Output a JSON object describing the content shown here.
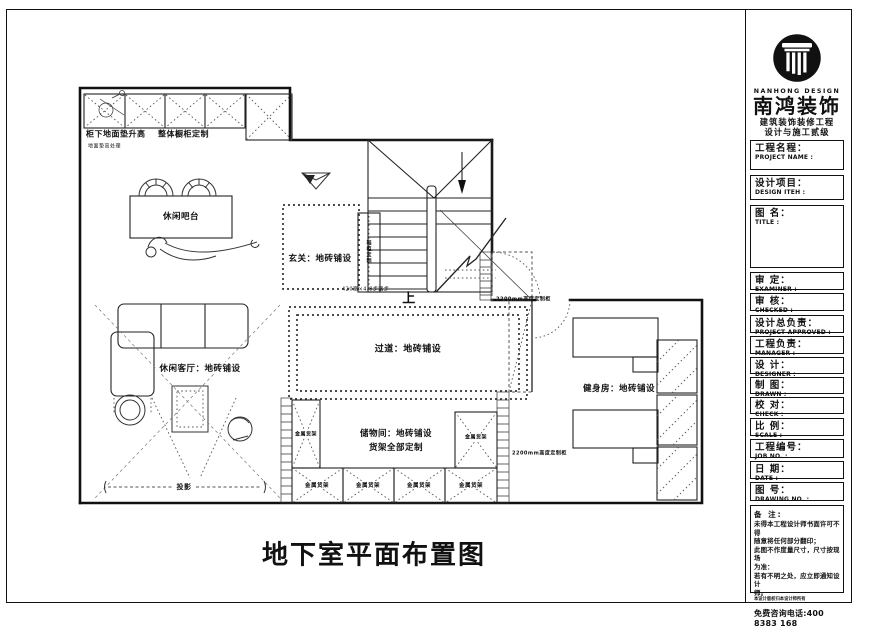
{
  "sheet": {
    "main_title": "地下室平面布置图"
  },
  "plan": {
    "labels": {
      "cabinet_note1": "柜下地面垫升高",
      "cabinet_note2": "整体橱柜定制",
      "floor_note": "地面垫高处理",
      "bar": "休闲吧台",
      "entry": "玄关：地砖铺设",
      "shoe_cabinet": "鞋柜定制",
      "stair_up": "上",
      "stair_note": "420宽×4-8步踏步",
      "cabinet_2200": "2200mm高度定制柜",
      "corridor": "过道：地砖铺设",
      "living": "休闲客厅：地砖铺设",
      "storage_line1": "储物间：地砖铺设",
      "storage_line2": "货架全部定制",
      "shelf": "金属货架",
      "gym": "健身房：地砖铺设",
      "projection": "投影"
    }
  },
  "titleblock": {
    "brand": {
      "logo_en": "NANHONG DESIGN",
      "name_zh": "南鸿装饰",
      "cert_line1": "建筑装饰装修工程",
      "cert_line2": "设计与施工贰级",
      "license_no": "*NO：X233021396"
    },
    "fields": [
      {
        "zh": "工程名程：",
        "en": "PROJECT NAME :"
      },
      {
        "zh": "设计项目：",
        "en": "DESIGN ITEH :"
      },
      {
        "zh": "图 名：",
        "en": "TITLE :"
      },
      {
        "zh": "审 定：",
        "en": "EXAMINER :"
      },
      {
        "zh": "审 核：",
        "en": "CHECKED :"
      },
      {
        "zh": "设计总负责：",
        "en": "PROJECT APPROVED :"
      },
      {
        "zh": "工程负责：",
        "en": "MANAGER :"
      },
      {
        "zh": "设 计：",
        "en": "DESIGNER :"
      },
      {
        "zh": "制 图：",
        "en": "DRAWN :"
      },
      {
        "zh": "校 对：",
        "en": "CHECK :"
      },
      {
        "zh": "比 例：",
        "en": "SCALE :"
      },
      {
        "zh": "工程编号：",
        "en": "JOB NO. :"
      },
      {
        "zh": "日 期：",
        "en": "DATE :"
      },
      {
        "zh": "图 号：",
        "en": "DRAWING NO. :"
      }
    ],
    "notes": {
      "title": "备 注:",
      "lines": [
        "未得本工程设计师书面许可不得",
        "随意将任何部分翻印；",
        "此图不作度量尺寸，尺寸按现场",
        "为准：",
        "若有不明之处，应立即通知设计",
        "师。",
        "本设计版权归本设计师所有"
      ],
      "phone": "免费咨询电话:400 8383 168"
    }
  }
}
